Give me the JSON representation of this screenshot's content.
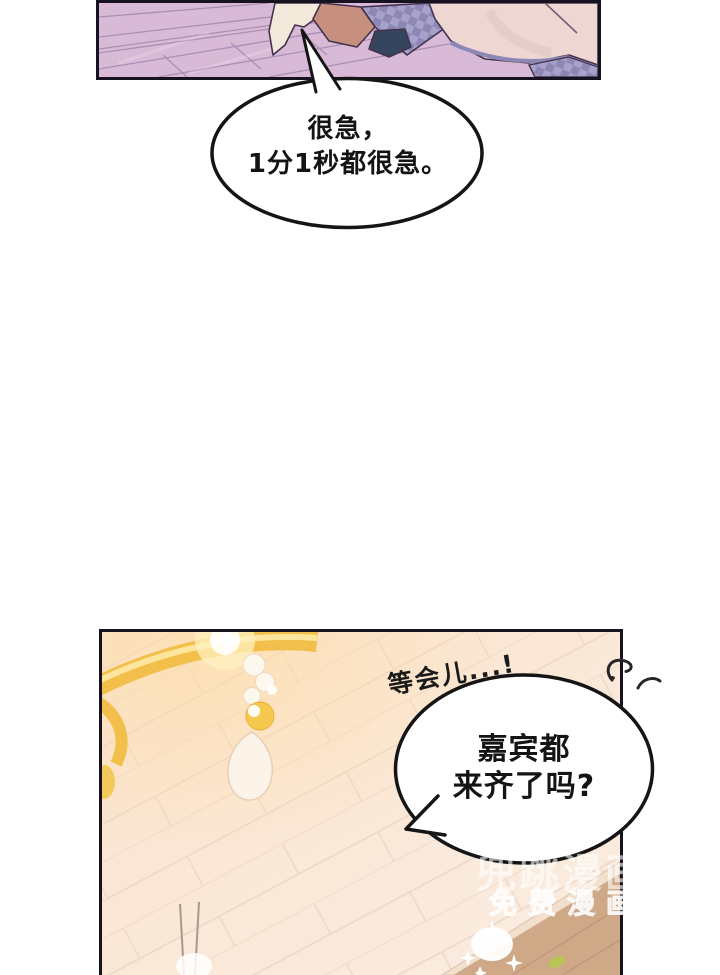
{
  "page": {
    "kind": "webtoon-comic-page"
  },
  "bubbles": {
    "top": {
      "lines": [
        "很急，",
        "1分1秒都很急。"
      ]
    },
    "bottom": {
      "lines": [
        "嘉宾都",
        "来齐了吗?"
      ]
    },
    "handwritten": "等会儿...!"
  },
  "watermark": {
    "lines": [
      "兜跳漫画",
      "免费漫画"
    ]
  },
  "colors": {
    "panel-border": "#17121f",
    "ink": "#151515",
    "floor-lavender": "#d8bad7",
    "tile-line-purple": "#a487ae",
    "skin-tan": "#c78f7e",
    "navy": "#36455e",
    "fabric-purple": "#8d87b5",
    "fabric-purple-light": "#a7a2c9",
    "dress-pink": "#eed7d3",
    "cream": "#f2e9db",
    "warm-bg-1": "#fbe2cc",
    "warm-bg-2": "#f9ede2",
    "tile-line-cream": "#eed6c5",
    "gold": "#f2bf4a",
    "gold-light": "#ffe9a6",
    "wood-floor": "#cfa888"
  }
}
